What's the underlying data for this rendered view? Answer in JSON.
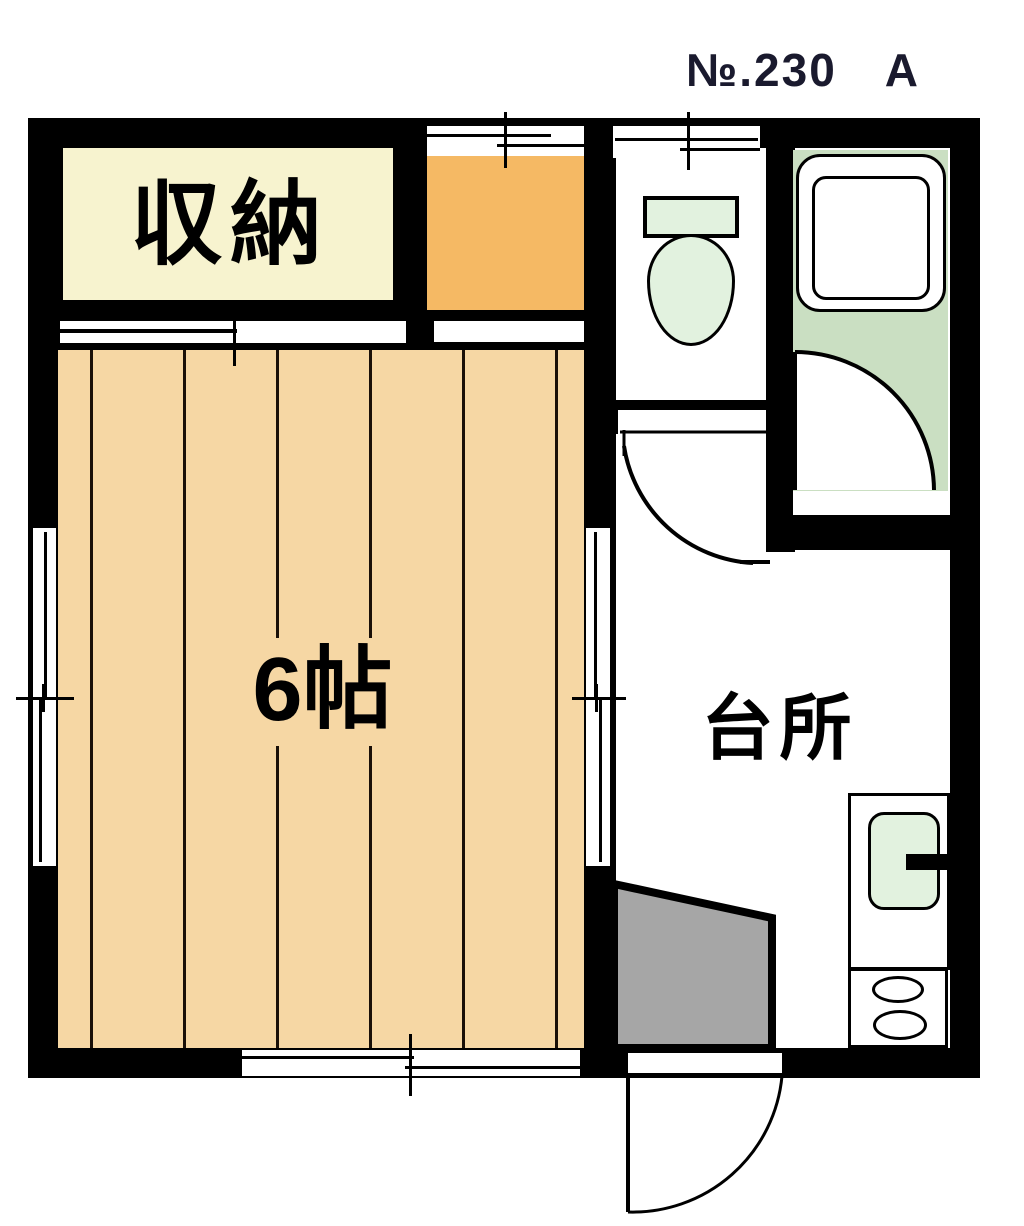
{
  "title": "№.230　A",
  "rooms": {
    "storage": {
      "label": "収納"
    },
    "main": {
      "label": "6帖"
    },
    "kitchen": {
      "label": "台所"
    }
  },
  "fixtures": {
    "toilet": "toilet-with-tank",
    "bathtub": "bathtub",
    "sink": "kitchen-sink-with-faucet",
    "stove": "two-burner-stove",
    "genkan": "entry-step",
    "doors": [
      "hall-swing-door",
      "bathroom-swing-door",
      "entrance-swing-door"
    ],
    "windows": [
      "left-wall-window",
      "middle-wall-window",
      "bottom-wall-window",
      "orange-room-window",
      "toilet-window",
      "storage-sliding-door",
      "orange-room-opening"
    ]
  },
  "colors": {
    "wall": "#000000",
    "floor_wood": "#F6D7A4",
    "storage_cream": "#F7F3CF",
    "orange": "#F5B964",
    "bath_green": "#CADFC2",
    "fixture_green": "#E2F2DF",
    "genkan_gray": "#A6A6A6",
    "bg": "#FFFFFF"
  }
}
